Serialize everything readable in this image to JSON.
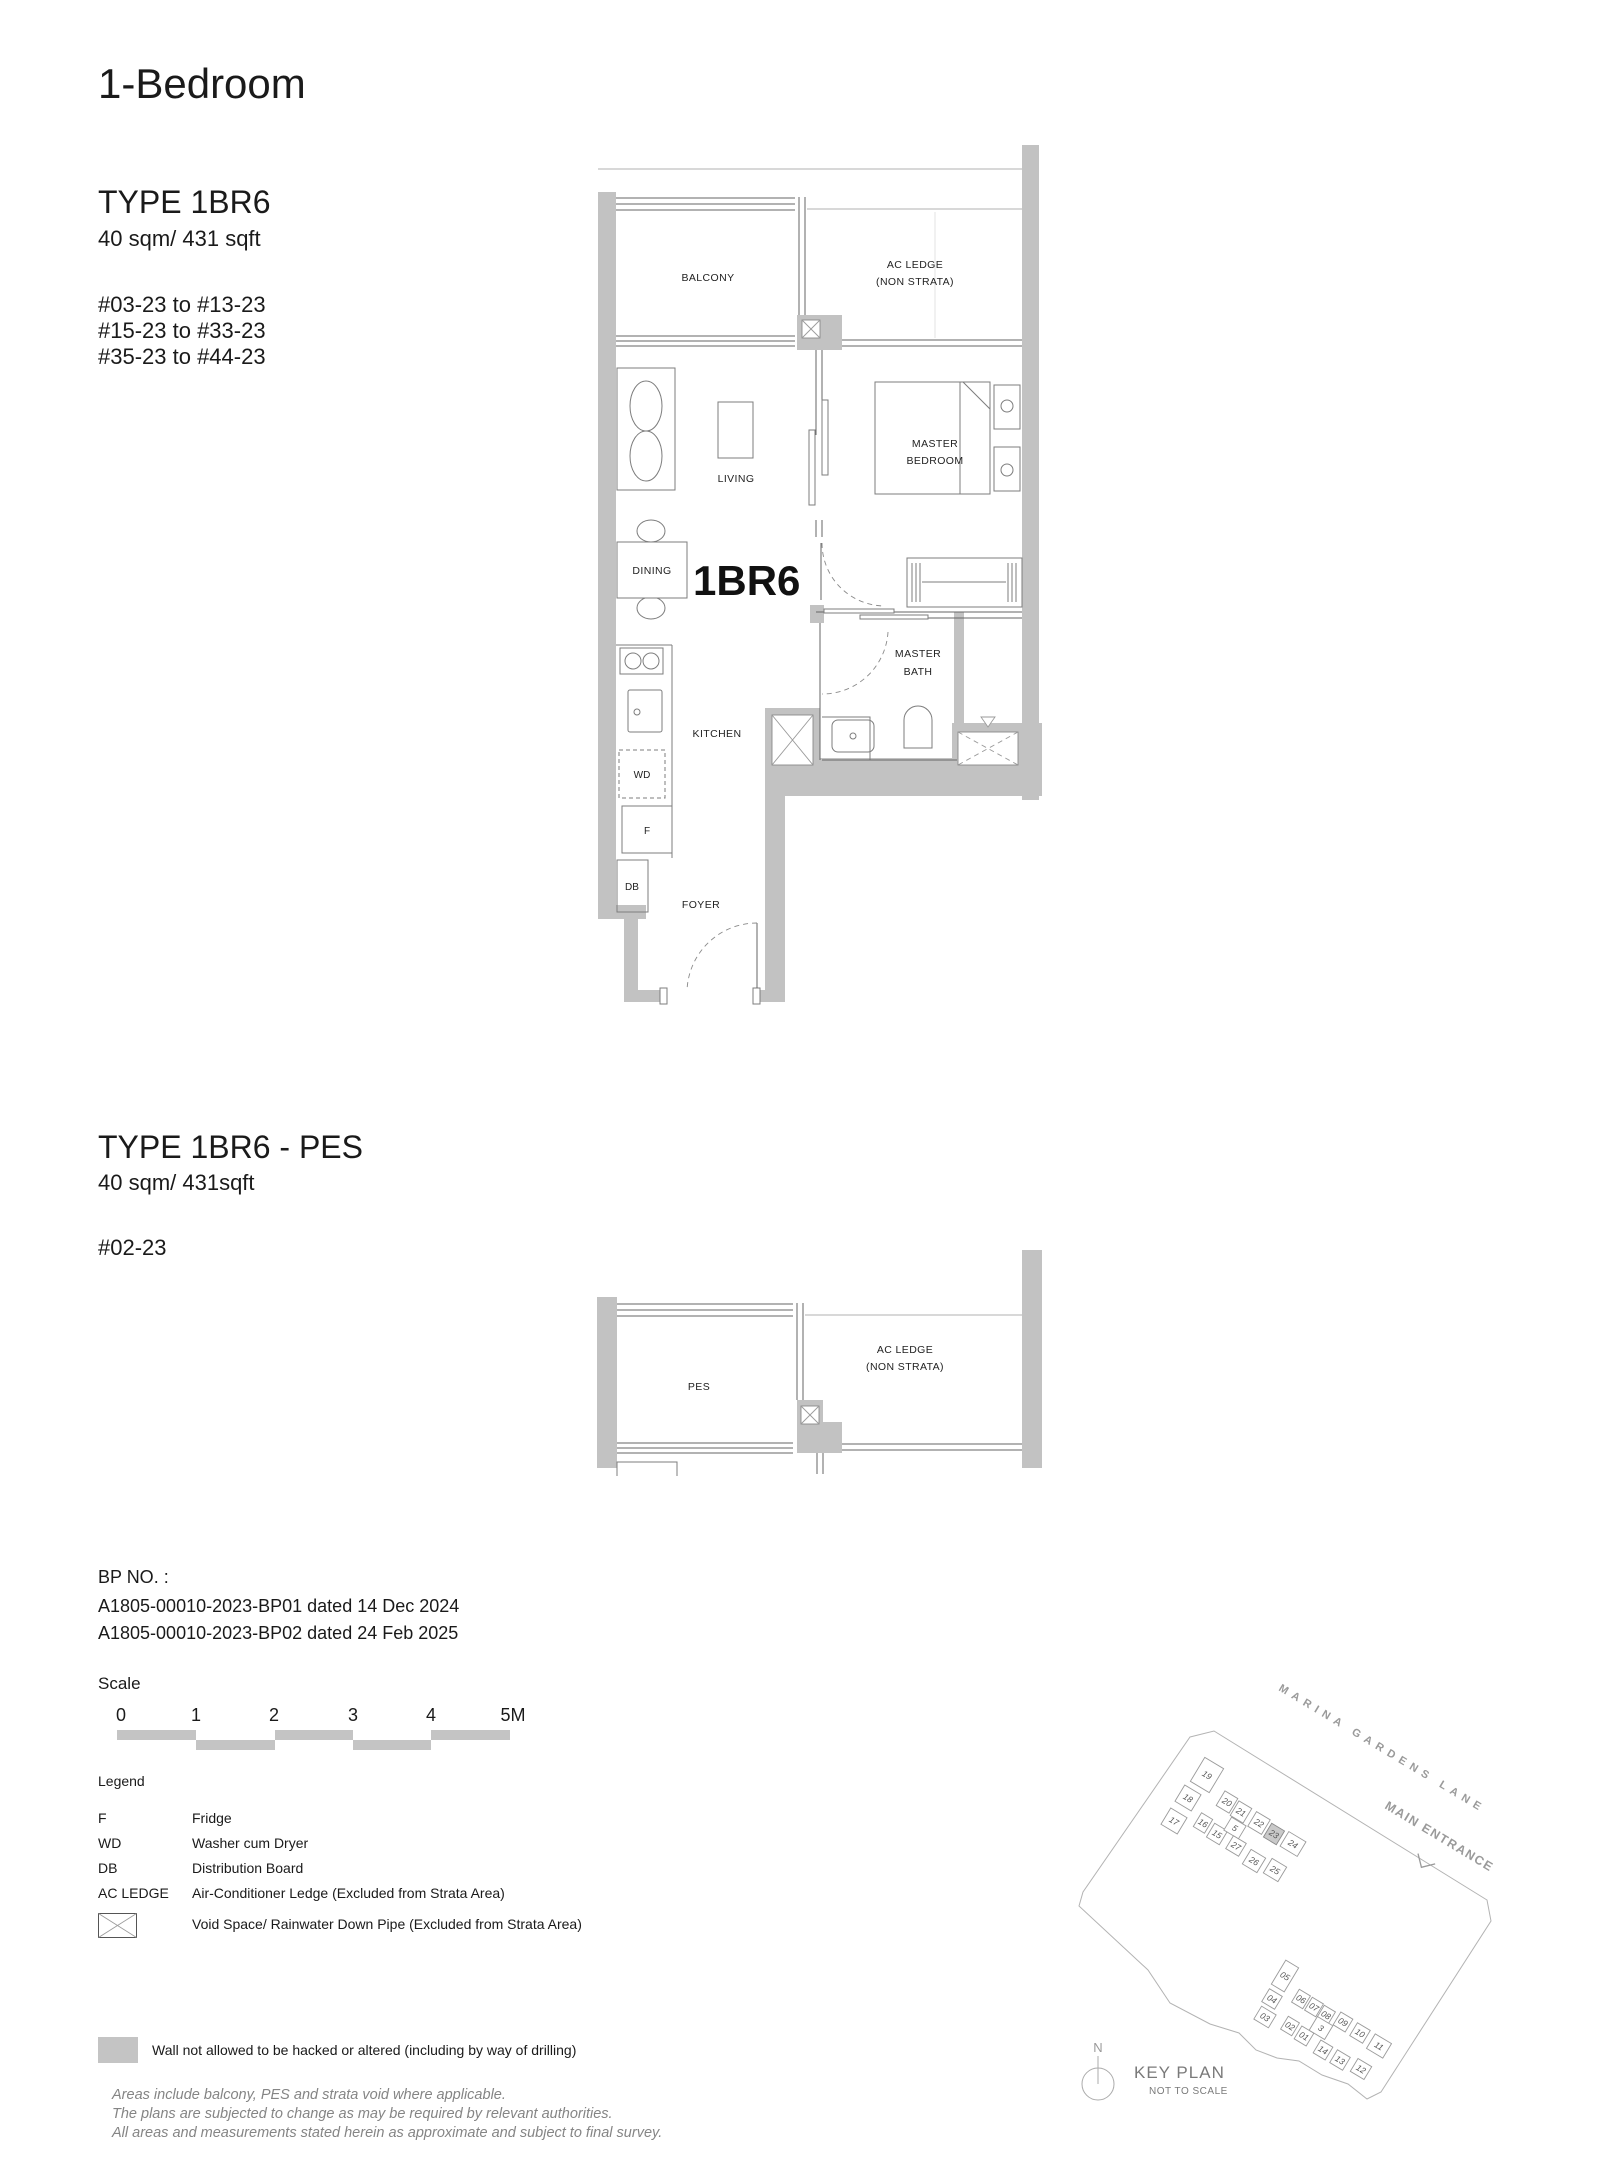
{
  "page": {
    "title": "1-Bedroom"
  },
  "plan1": {
    "type_label": "TYPE 1BR6",
    "area": "40 sqm/ 431 sqft",
    "unit_ranges": [
      "#03-23 to #13-23",
      "#15-23 to #33-23",
      "#35-23 to #44-23"
    ],
    "unit_tag": "1BR6",
    "rooms": {
      "balcony": "BALCONY",
      "ac_ledge_1": "AC LEDGE",
      "ac_ledge_2": "(NON STRATA)",
      "living": "LIVING",
      "master_1": "MASTER",
      "master_2": "BEDROOM",
      "dining": "DINING",
      "bath_1": "MASTER",
      "bath_2": "BATH",
      "kitchen": "KITCHEN",
      "foyer": "FOYER",
      "wd": "WD",
      "fridge": "F",
      "db": "DB"
    }
  },
  "plan2": {
    "type_label": "TYPE 1BR6 - PES",
    "area": "40 sqm/ 431sqft",
    "unit_ranges": [
      "#02-23"
    ],
    "rooms": {
      "pes": "PES",
      "ac_ledge_1": "AC LEDGE",
      "ac_ledge_2": "(NON STRATA)"
    }
  },
  "bp_no": {
    "label": "BP NO. :",
    "lines": [
      "A1805-00010-2023-BP01 dated 14 Dec 2024",
      "A1805-00010-2023-BP02 dated 24 Feb 2025"
    ]
  },
  "scale": {
    "label": "Scale",
    "ticks": [
      "0",
      "1",
      "2",
      "3",
      "4",
      "5M"
    ]
  },
  "legend": {
    "title": "Legend",
    "rows": [
      {
        "abbr": "F",
        "desc": "Fridge"
      },
      {
        "abbr": "WD",
        "desc": "Washer cum Dryer"
      },
      {
        "abbr": "DB",
        "desc": "Distribution Board"
      },
      {
        "abbr": "AC LEDGE",
        "desc": "Air-Conditioner Ledge (Excluded from Strata Area)"
      }
    ],
    "void_desc": "Void Space/ Rainwater Down Pipe (Excluded from Strata Area)"
  },
  "wall_note": "Wall not allowed to be hacked or altered (including by way of drilling)",
  "disclaimer": [
    "Areas include balcony, PES and strata void where applicable.",
    "The plans are subjected to change as may be required by relevant authorities.",
    "All areas and measurements stated herein as approximate and subject to final survey."
  ],
  "keyplan": {
    "street": "MARINA GARDENS LANE",
    "entrance": "MAIN ENTRANCE",
    "north": "N",
    "title": "KEY PLAN",
    "subtitle": "NOT TO SCALE",
    "highlight": "23",
    "top_units": [
      "19",
      "18",
      "17",
      "20",
      "21",
      "22",
      "23",
      "24",
      "16",
      "15",
      "5",
      "27",
      "26",
      "25"
    ],
    "bottom_units": [
      "05",
      "04",
      "03",
      "06",
      "07",
      "08",
      "09",
      "02",
      "01",
      "3",
      "10",
      "11",
      "14",
      "13",
      "12"
    ]
  },
  "colors": {
    "wall": "#c2c2c2",
    "accent_gray": "#c4c4c4",
    "muted_text": "#858585"
  }
}
